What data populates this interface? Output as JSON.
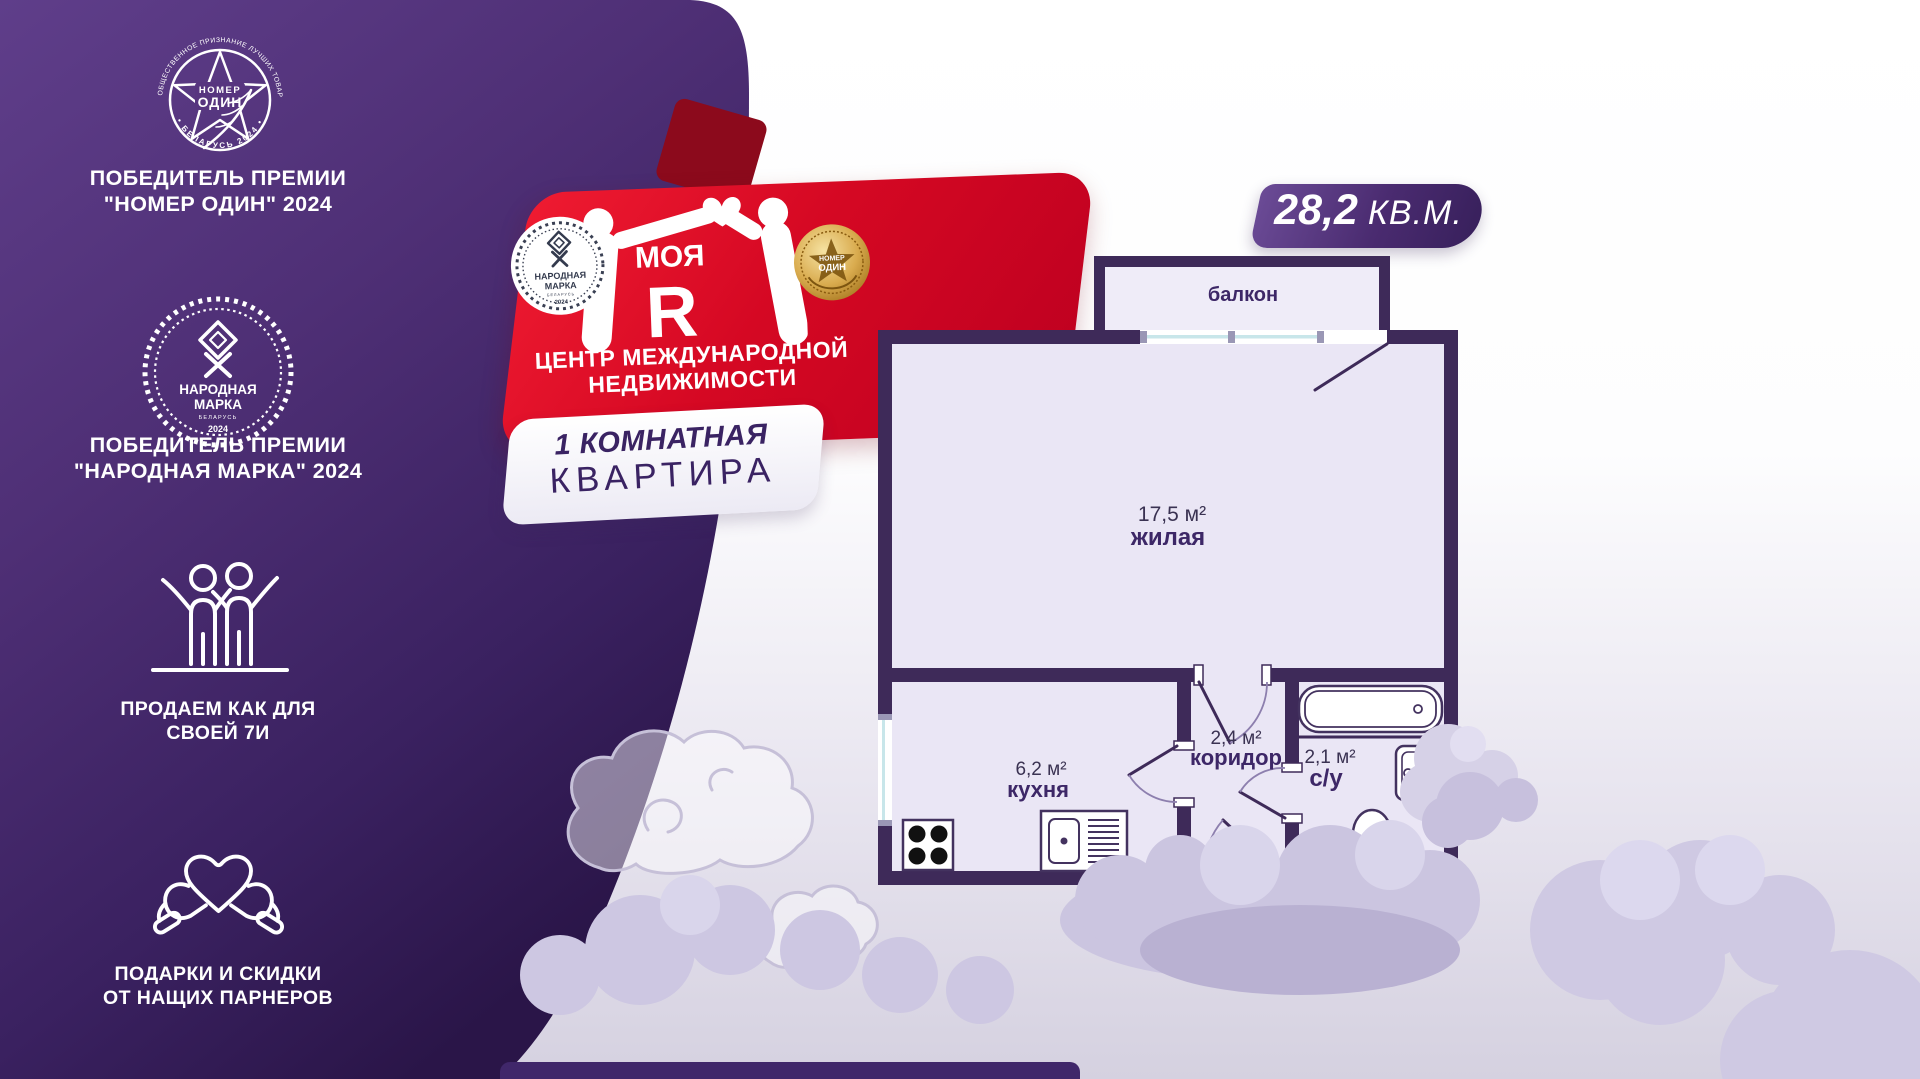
{
  "awards": {
    "award1": {
      "ring_top": "ПРЕМИЯ ЗА ОБЩЕСТВЕННОЕ ПРИЗНАНИЕ ЛУЧШИХ ТОВАРОВ И УСЛУГ",
      "ring_bottom": "• БЕЛАРУСЬ 2024 •",
      "center_top": "НОМЕР",
      "center_bottom": "ОДИН",
      "caption1": "ПОБЕДИТЕЛЬ ПРЕМИИ",
      "caption2": "\"НОМЕР ОДИН\" 2024"
    },
    "award2": {
      "title1": "НАРОДНАЯ",
      "title2": "МАРКА",
      "subtitle": "БЕЛАРУСЬ",
      "year": "2024",
      "caption1": "ПОБЕДИТЕЛЬ ПРЕМИИ",
      "caption2": "\"НАРОДНАЯ МАРКА\" 2024"
    },
    "feature_family": {
      "line1": "ПРОДАЕМ КАК ДЛЯ",
      "line2": "СВОЕЙ 7И"
    },
    "feature_gifts": {
      "line1": "ПОДАРКИ И СКИДКИ",
      "line2": "ОТ НАЩИХ ПАРНЕРОВ"
    }
  },
  "brand": {
    "logo_word": "МОЯ",
    "logo_letter": "Я",
    "tagline1": "ЦЕНТР МЕЖДУНАРОДНОЙ",
    "tagline2": "НЕДВИЖИМОСТИ",
    "seal": {
      "title1": "НАРОДНАЯ",
      "title2": "МАРКА",
      "subtitle": "БЕЛАРУСЬ",
      "year": "2024"
    },
    "medal": {
      "line1": "НОМЕР",
      "line2": "ОДИН"
    }
  },
  "listing": {
    "type_line1": "1 КОМНАТНАЯ",
    "type_line2": "КВАРТИРА",
    "area_value": "28,2",
    "area_unit": "КВ.М."
  },
  "floorplan": {
    "balcony_label": "балкон",
    "living": {
      "area": "17,5 м²",
      "name": "жилая"
    },
    "kitchen": {
      "area": "6,2 м²",
      "name": "кухня"
    },
    "corridor": {
      "area": "2,4 м²",
      "name": "коридор"
    },
    "bathroom": {
      "area": "2,1 м²",
      "name": "с/у"
    }
  },
  "colors": {
    "panel_purple": "#4b2d72",
    "banner_red": "#d50823",
    "wall_dark": "#3e2a59",
    "floor_light": "#eae6f5",
    "badge_purple": "#46296b",
    "cloud": "#cdc7e1"
  }
}
